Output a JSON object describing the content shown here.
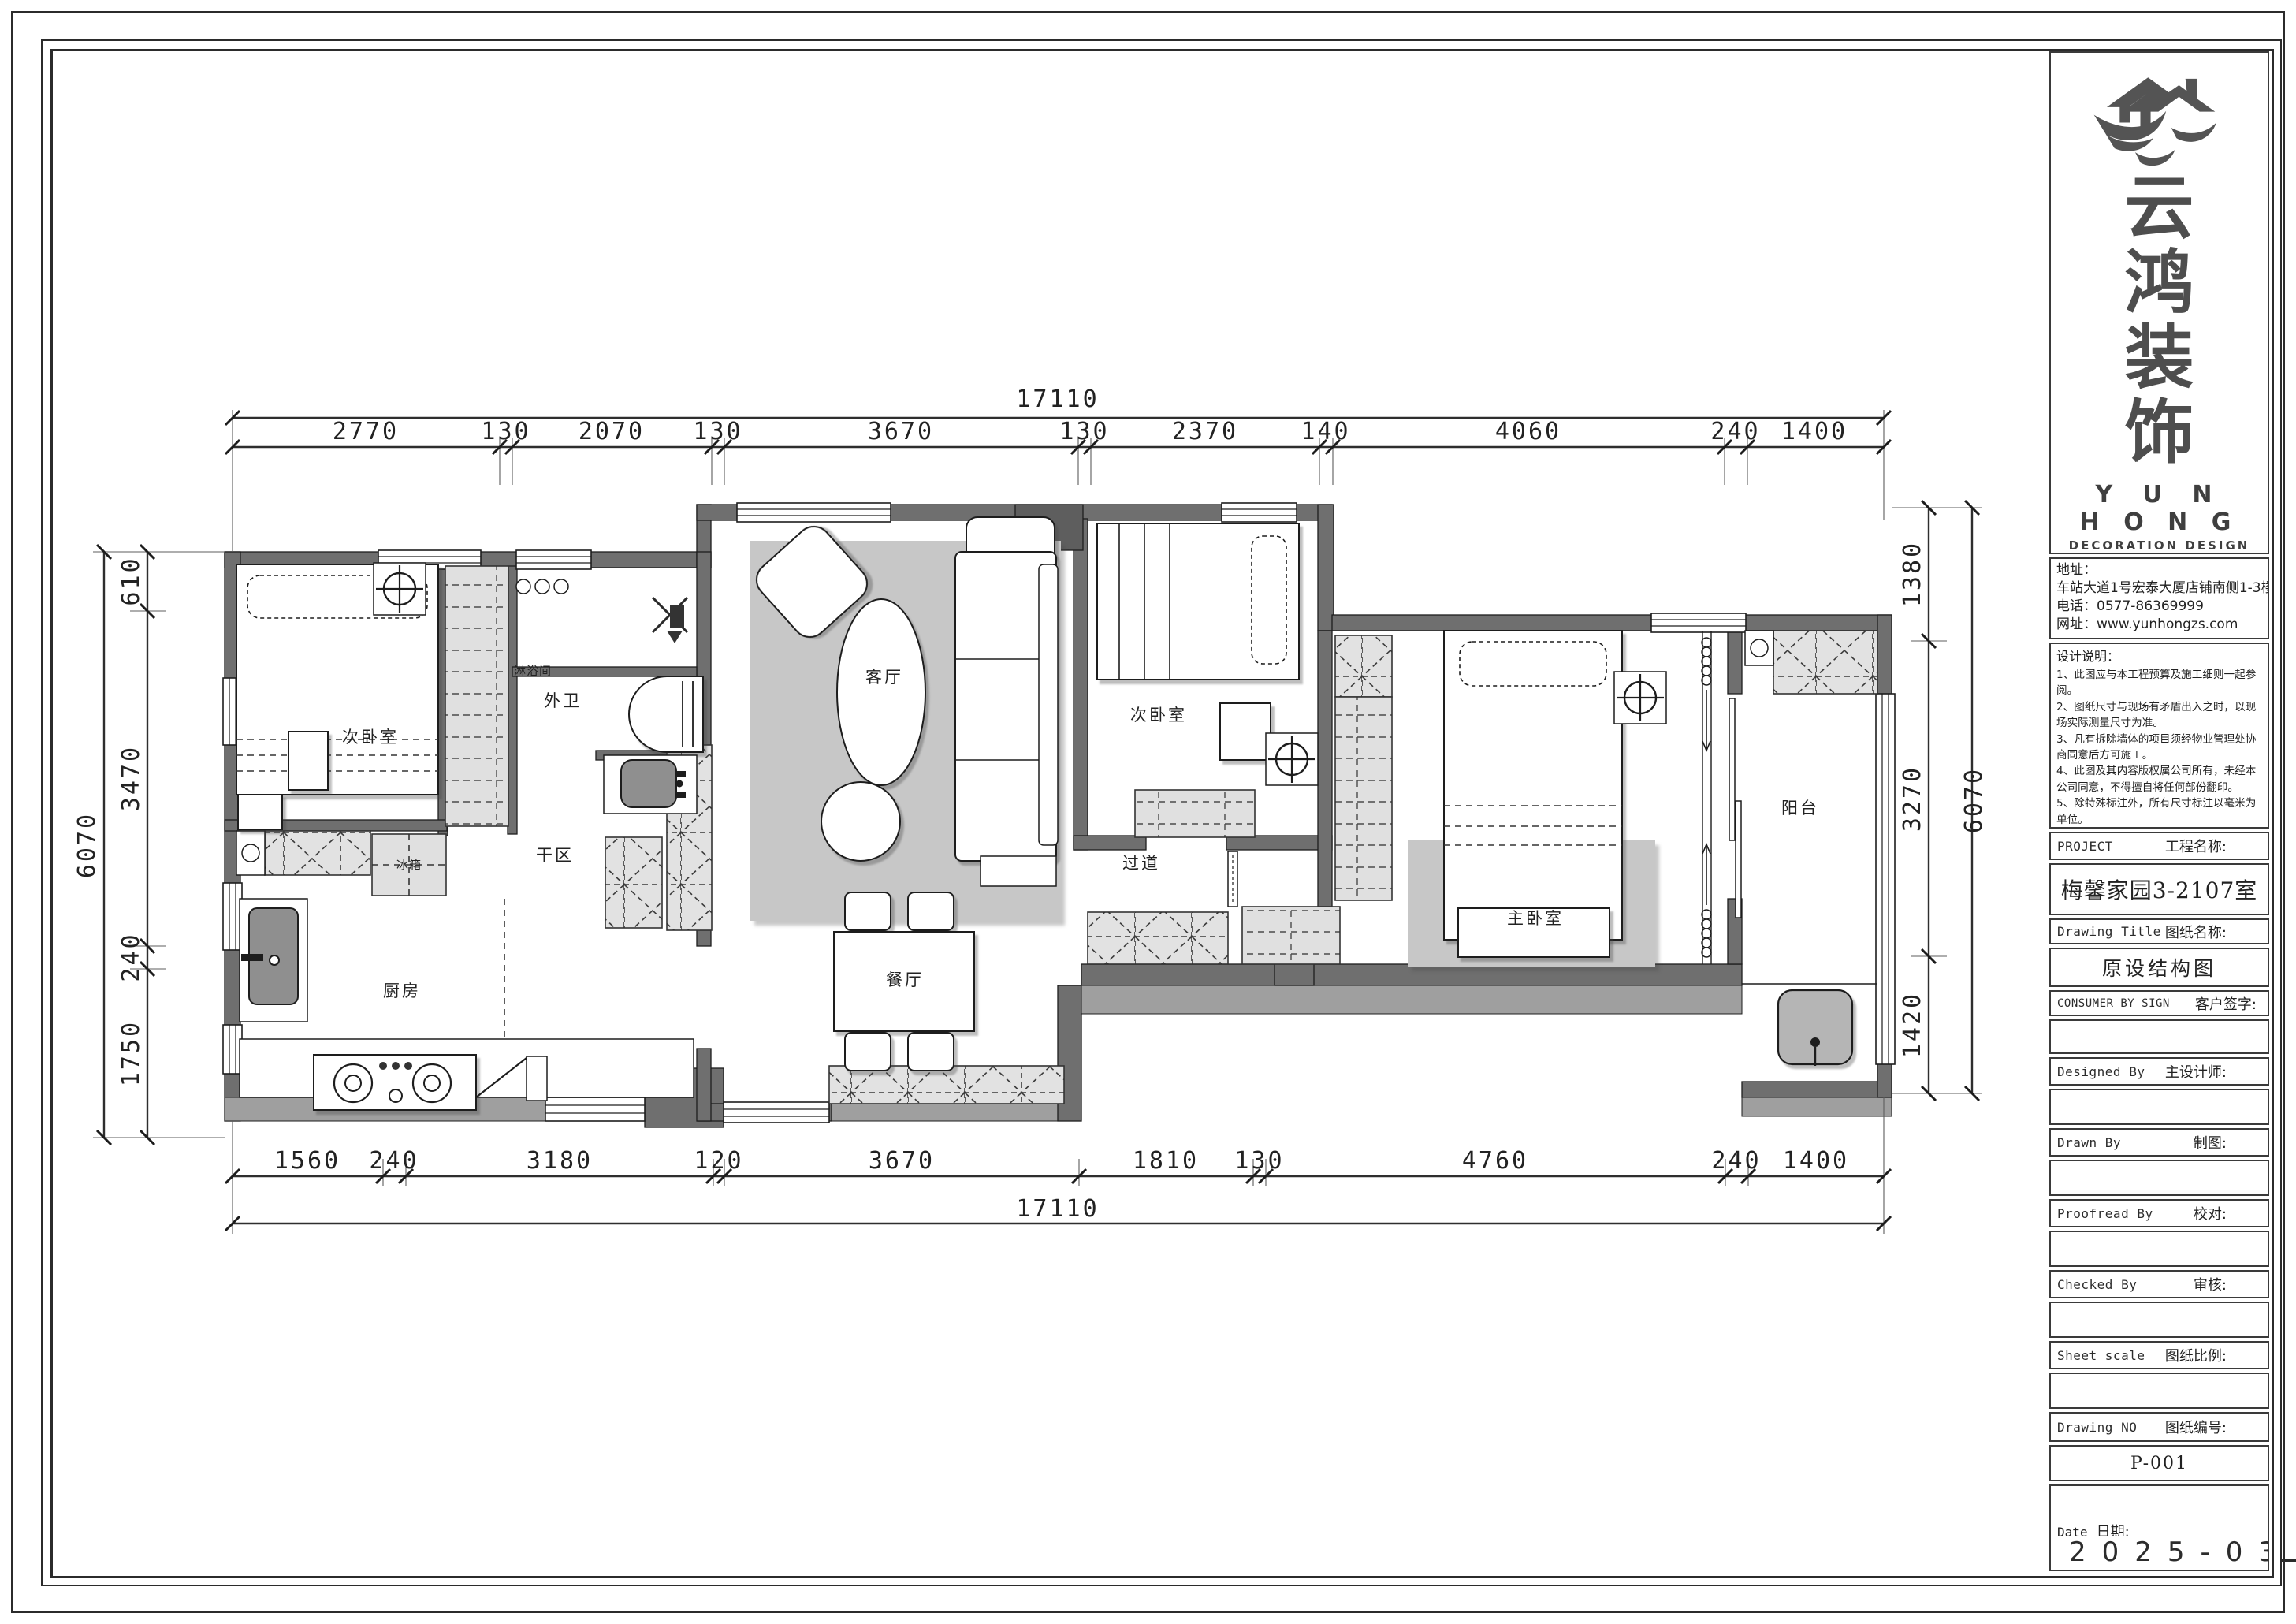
{
  "title_block": {
    "logo": {
      "icon": "roof-and-birds-logo",
      "chars": [
        "云",
        "鸿",
        "装",
        "饰"
      ],
      "en_line1": "Y U N",
      "en_line2": "H O N G",
      "en_line3": "DECORATION  DESIGN"
    },
    "contact": {
      "address_label": "地址：",
      "address": "车站大道1号宏泰大厦店铺南侧1-3楼",
      "phone": "电话：0577-86369999",
      "website": "网址：www.yunhongzs.com"
    },
    "notes": {
      "heading": "设计说明：",
      "items": [
        "1、此图应与本工程预算及施工细则一起参阅。",
        "2、图纸尺寸与现场有矛盾出入之时，以现场实际测量尺寸为准。",
        "3、凡有拆除墙体的项目须经物业管理处协商同意后方可施工。",
        "4、此图及其内容版权属公司所有，未经本公司同意，不得擅自将任何部份翻印。",
        "5、除特殊标注外，所有尺寸标注以毫米为单位。",
        "6、该图纸为施工图纸，双方（客户和设计师）签字认可后，方可指导施工。"
      ]
    },
    "fields": {
      "project_label": "PROJECT",
      "project_label_cn": "工程名称:",
      "project_value": "梅馨家园3-2107室",
      "drawing_title_label": "Drawing Title",
      "drawing_title_label_cn": "图纸名称:",
      "drawing_title_value": "原设结构图",
      "consumer_label": "CONSUMER BY SIGN",
      "consumer_label_cn": "客户签字:",
      "designed_label": "Designed By",
      "designed_label_cn": "主设计师:",
      "drawn_label": "Drawn By",
      "drawn_label_cn": "制图:",
      "proofread_label": "Proofread By",
      "proofread_label_cn": "校对:",
      "checked_label": "Checked By",
      "checked_label_cn": "审核:",
      "scale_label": "Sheet scale",
      "scale_label_cn": "图纸比例:",
      "number_label": "Drawing NO",
      "number_label_cn": "图纸编号:",
      "number_value": "P-001",
      "date_label": "Date",
      "date_label_cn": "日期:",
      "date_value": "2025-03"
    }
  },
  "plan": {
    "labels": {
      "bedroom_left": "次卧室",
      "shower": "淋浴间",
      "bath": "外卫",
      "dry_area": "干区",
      "fridge": "冰箱",
      "kitchen": "厨房",
      "living": "客厅",
      "dining": "餐厅",
      "bedroom_mid": "次卧室",
      "corridor": "过道",
      "master": "主卧室",
      "balcony": "阳台"
    },
    "icons": {
      "north_symbol": "crosshair-circle",
      "shower_head": "shower-head",
      "washer": "washing-machine",
      "stove": "gas-stove",
      "bathtub": "bathtub"
    },
    "dims": {
      "top_total": "17110",
      "top": [
        "2770",
        "130",
        "2070",
        "130",
        "3670",
        "130",
        "2370",
        "140",
        "4060",
        "240",
        "1400"
      ],
      "bottom": [
        "1560",
        "240",
        "3180",
        "120",
        "3670",
        "1810",
        "130",
        "4760",
        "240",
        "1400"
      ],
      "bottom_total": "17110",
      "left_total": "6070",
      "left": [
        "610",
        "3470",
        "240",
        "1750"
      ],
      "right": [
        "1380",
        "3270",
        "1420"
      ],
      "right_total": "6070"
    },
    "colors": {
      "wall": "#6f6f6f",
      "wall_light": "#9f9f9f",
      "hatch_fill": "#e2e2e2",
      "rug": "#c7c7c7",
      "line": "#1d1d1d"
    }
  }
}
